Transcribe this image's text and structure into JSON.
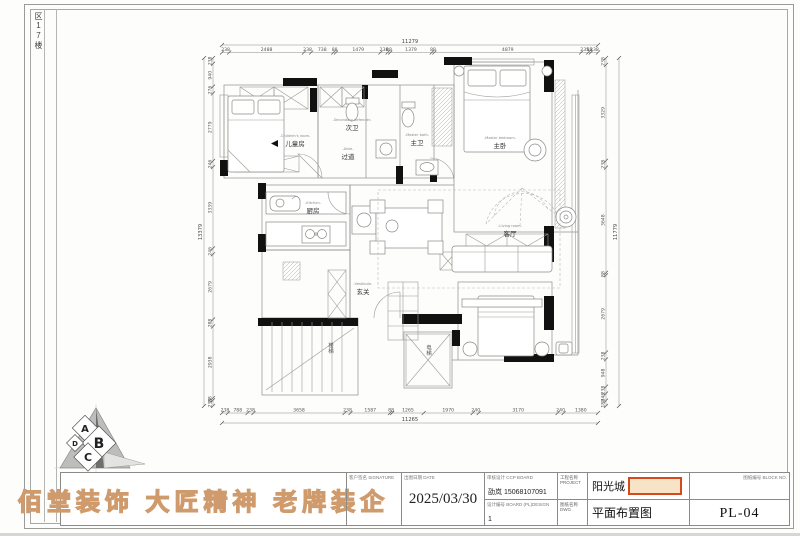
{
  "sheet": {
    "side_label": "区17楼"
  },
  "logo": {
    "slogan": "佰堂装饰 大匠精神 老牌装企",
    "letters": [
      "A",
      "B",
      "C",
      "D"
    ]
  },
  "title_block": {
    "signature_label": "客户签名 SIGNATURE",
    "date_label": "出图日期 DATE",
    "date_value": "2025/03/30",
    "contact_label": "审核设计 CCP BOARD",
    "contact_value": "劭岚 15068107091",
    "design_no_label": "设计编号 BOARD (PL)DESIGN",
    "design_no_value": "1",
    "project_label": "工程名称 PROJECT",
    "project_value": "阳光城",
    "drawing_label": "图纸名称 DWG",
    "drawing_value": "平面布置图",
    "sheet_no_label": "图纸编号 BLOCK NO.",
    "sheet_no_value": "PL-04"
  },
  "rooms": {
    "children": {
      "cn": "儿童房",
      "en": "-Children's room-"
    },
    "sec_bath": {
      "cn": "次卫",
      "en": "-Secondary defender-"
    },
    "aisle": {
      "cn": "过道",
      "en": "-Aisle-"
    },
    "master_bath": {
      "cn": "主卫",
      "en": "-Master bath-"
    },
    "master_bed": {
      "cn": "主卧",
      "en": "-Master bedroom-"
    },
    "kitchen": {
      "cn": "厨房",
      "en": "-Kitchen-"
    },
    "living": {
      "cn": "客厅",
      "en": "-Living room-"
    },
    "vestibule": {
      "cn": "玄关",
      "en": "-Vestibule-"
    },
    "stairs": {
      "cn": "楼梯"
    },
    "elevator": {
      "cn": "电梯"
    }
  },
  "dimensions": {
    "top": {
      "total": "11279",
      "segments": [
        238,
        2488,
        238,
        738,
        88,
        1479,
        238,
        88,
        1379,
        88,
        4879,
        235,
        88,
        238
      ]
    },
    "bottom": {
      "total": "11265",
      "segments": [
        238,
        788,
        238,
        3658,
        238,
        1587,
        88,
        1265,
        1970,
        240,
        3170,
        240,
        1380
      ]
    },
    "left": {
      "total": "13379",
      "segments": [
        238,
        940,
        276,
        2779,
        246,
        3339,
        246,
        2679,
        288,
        2938,
        88,
        238
      ]
    },
    "right": {
      "total": "11779",
      "segments": [
        238,
        3329,
        238,
        3648,
        88,
        2679,
        238,
        948,
        238,
        246,
        188
      ]
    }
  }
}
